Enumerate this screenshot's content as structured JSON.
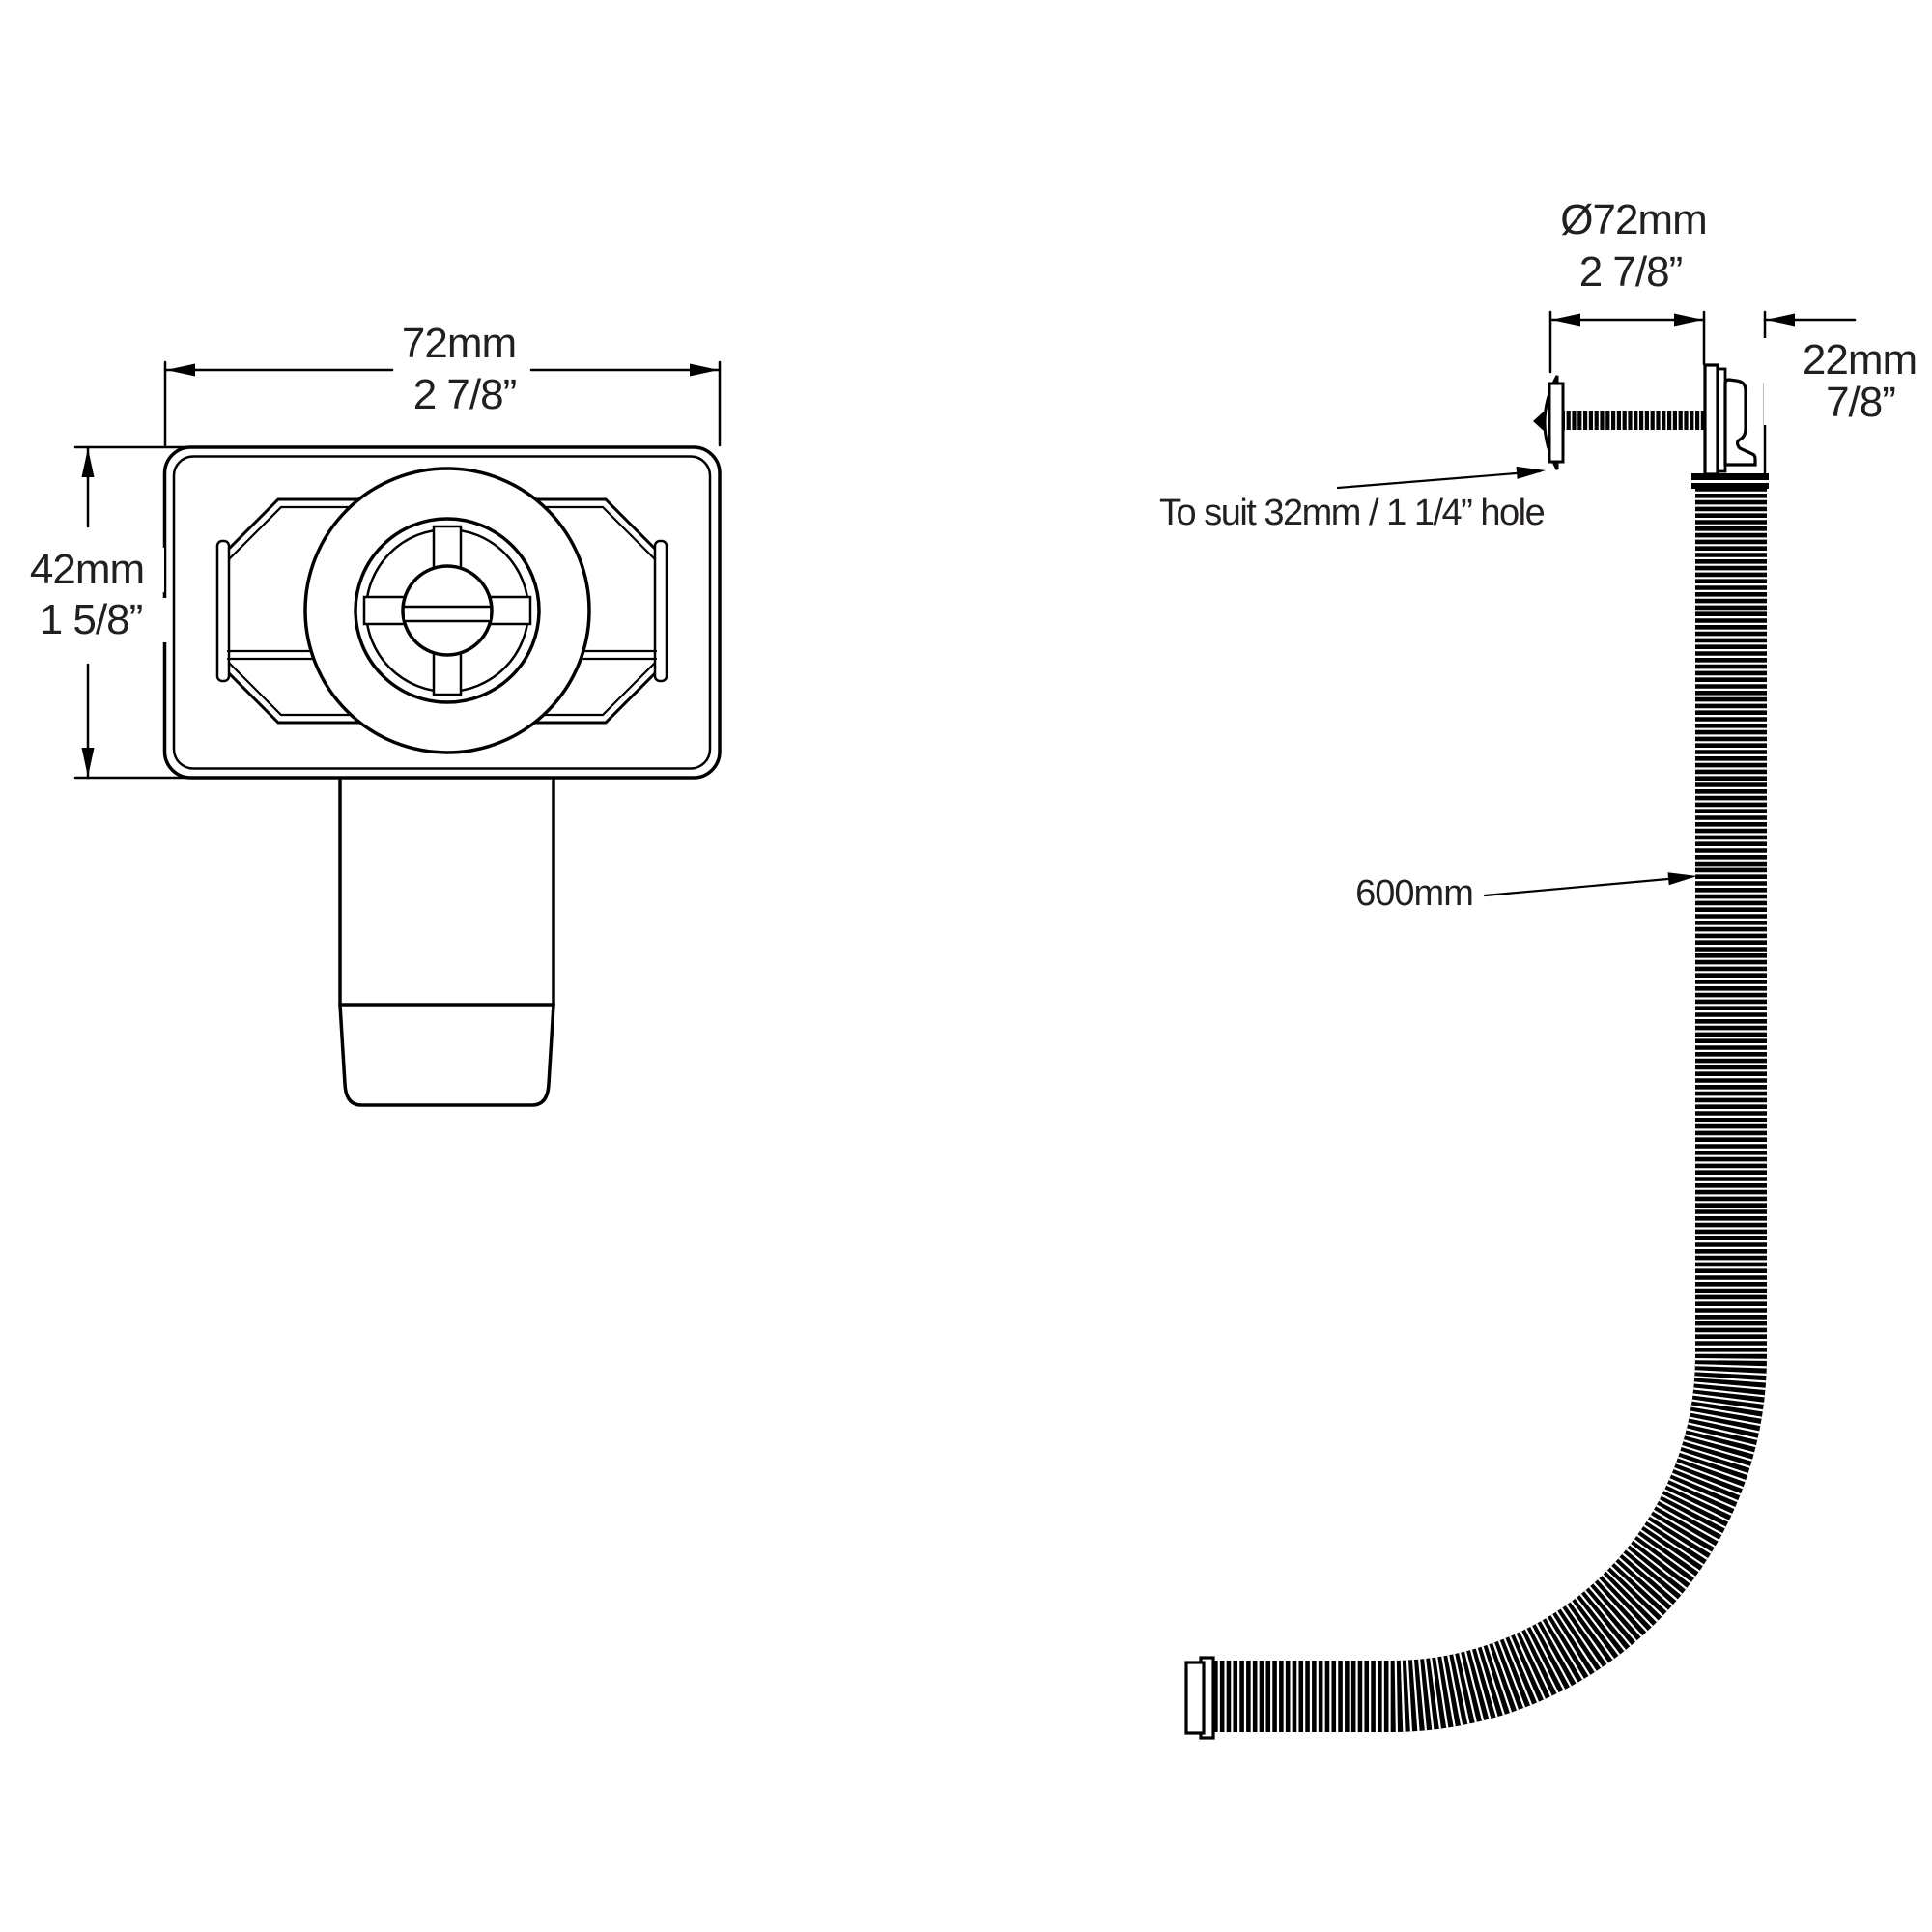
{
  "drawing": {
    "type": "technical-drawing",
    "product": "bath overflow filler with flexible hose",
    "colors": {
      "line": "#000000",
      "text": "#231f20",
      "background": "#ffffff"
    }
  },
  "front_view": {
    "width_mm": "72mm",
    "width_in": "2 7/8”",
    "height_mm": "42mm",
    "height_in": "1 5/8”"
  },
  "side_view": {
    "diameter_mm": "Ø72mm",
    "diameter_in": "2 7/8”",
    "depth_mm": "22mm",
    "depth_in": "7/8”",
    "hose_length": "600mm",
    "hole_note": "To suit 32mm / 1 1/4” hole"
  }
}
